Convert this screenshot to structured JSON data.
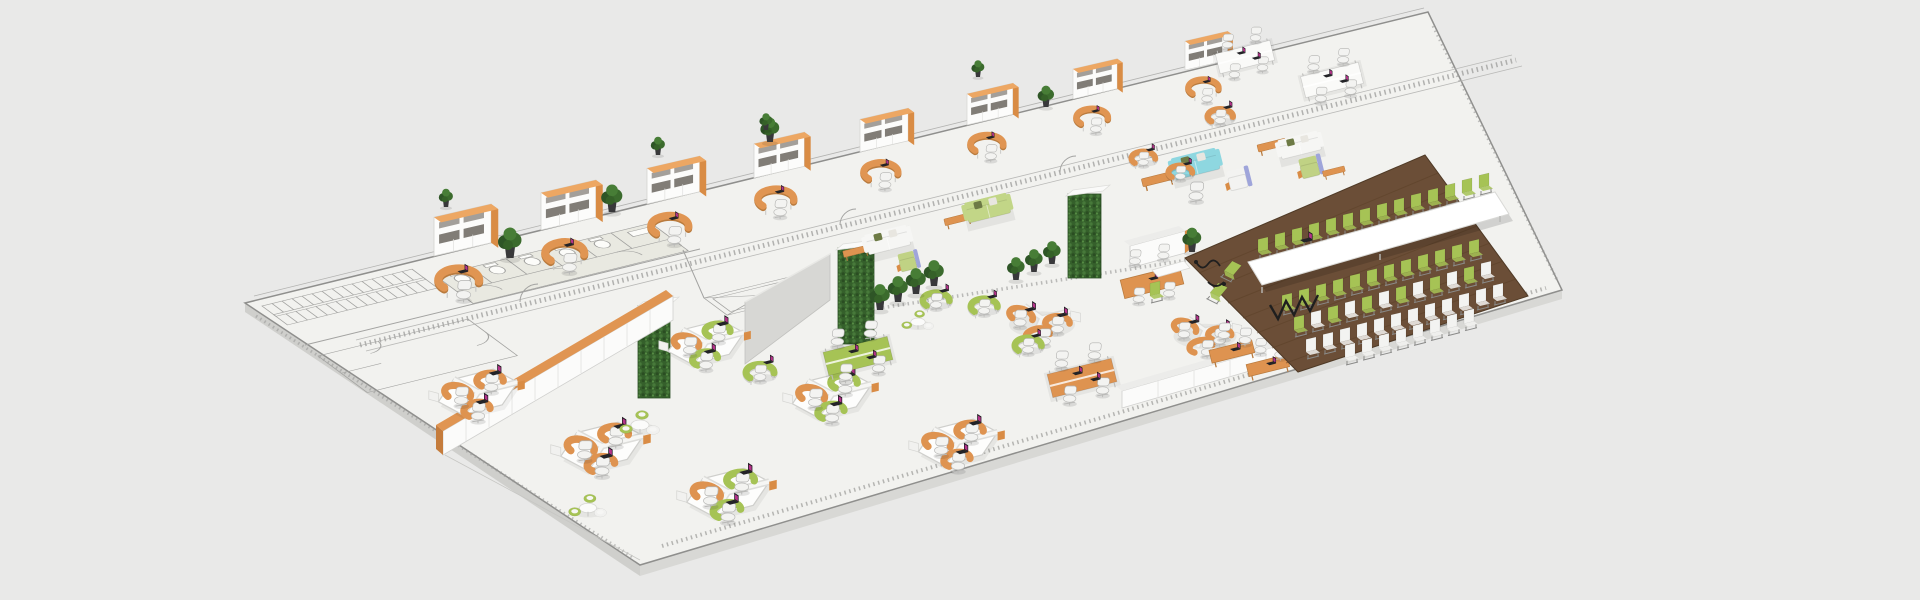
{
  "scene": {
    "type": "isometric-office-floorplan-3d-render",
    "canvas": {
      "width": 1920,
      "height": 600,
      "background": "#e9e9e8"
    },
    "palette": {
      "floor_plate": "#f2f2ef",
      "plate_side": "#d8d8d5",
      "outline_gray": "#8f8f8d",
      "cad_line": "#a3a3a1",
      "desk_orange": "#de9350",
      "desk_orange_dark": "#b97b3e",
      "cabinet_top_orange": "#eda763",
      "furniture_green": "#a6c355",
      "plant_green_dark": "#2e5526",
      "plant_wall_green": "#35602b",
      "conference_wood": "#6b4e37",
      "wood_plank_line": "#5c4128",
      "sofa_cyan": "#8ed7e0",
      "sofa_light_green": "#c2d687",
      "accent_lavender": "#9fa5da",
      "chair_white": "#f3f3f1",
      "laptop_screen_magenta": "#b5338a",
      "cable_black": "#1f1f1f",
      "wall_gray": "#d7d7d4"
    },
    "labels": {
      "plate": "office-floor-plate",
      "core": "building-core-cad-linework",
      "offices": "private-offices-row",
      "bench_desks": "white-bench-workstations",
      "lounges": "lounge-seating-groups",
      "green_walls": "vertical-garden-pillars",
      "storage": "storage-cabinet-rows",
      "open_space": "open-plan-workspace",
      "conference": "conference-townhall-area",
      "plants": "potted-plants"
    },
    "inventory": {
      "private_office_bays": 8,
      "plants_on_cabinets": 4,
      "white_bench_desks": 2,
      "honeycomb_clusters": 6,
      "y_shaped_clusters": 2,
      "bench_desk_green": 1,
      "bench_desk_orange": 1,
      "meeting_table_orange": 1,
      "training_tables": 2,
      "single_desks_green": 4,
      "single_desks_orange": 2,
      "lounge_round_tables": 3,
      "sofas": {
        "cyan": 1,
        "white": 2,
        "light_green": 1
      },
      "accent_armchairs": 3,
      "coffee_benches_orange": 5,
      "green_wall_pillars": 3,
      "floor_plants": 12,
      "laptops": 43,
      "stairs_flights": 2,
      "restroom_stalls": 5,
      "elevator_shaft": 1
    },
    "conference": {
      "floor": "dark-wood-planks",
      "table_color": "#ffffff",
      "laptop_on_table": 1,
      "chairs_back_row_green": 14,
      "chairs_table_end_green": 2,
      "front_rows": [
        {
          "color": "green",
          "count": 12
        },
        {
          "color": "mixed-green-white",
          "count": 12
        },
        {
          "color": "white",
          "count": 12
        },
        {
          "color": "white",
          "count": 8
        }
      ],
      "power_cables": 2
    }
  }
}
